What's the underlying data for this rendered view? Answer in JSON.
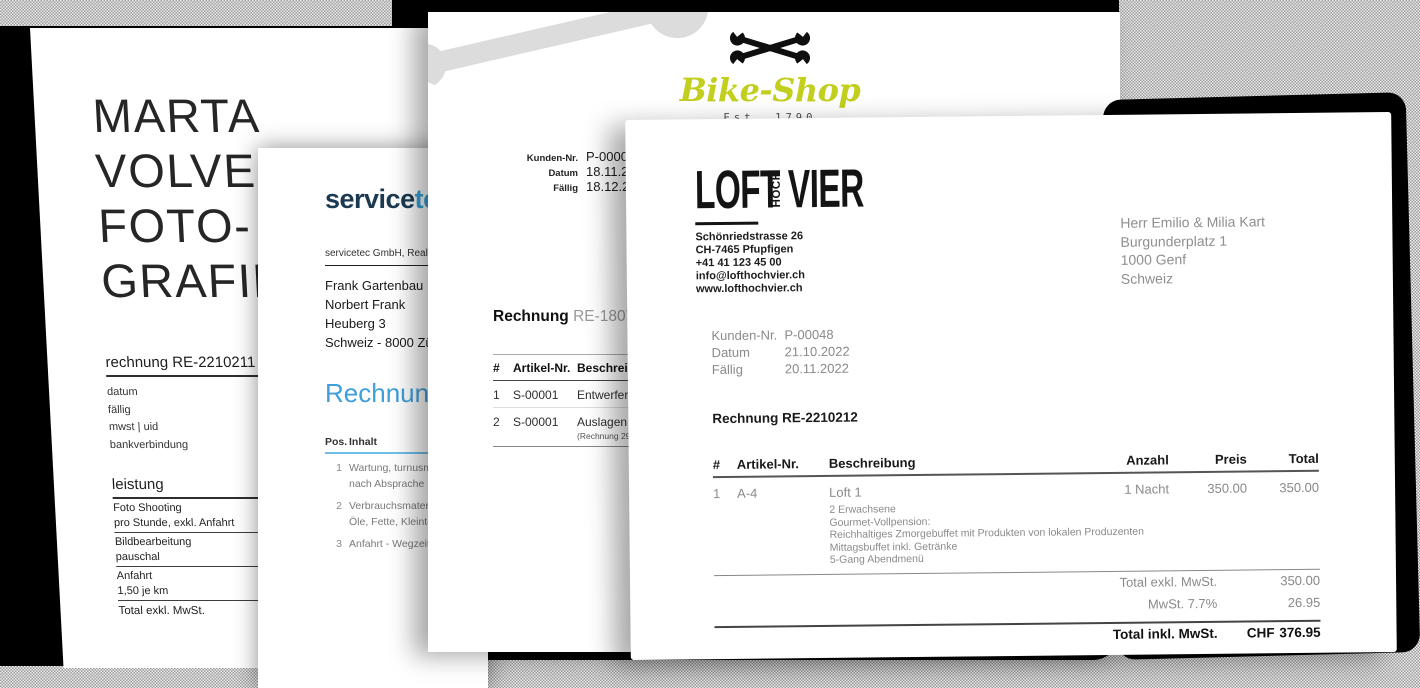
{
  "colors": {
    "backdrop": "#000000",
    "paper": "#ffffff",
    "servicetec_navy": "#1b3a52",
    "servicetec_lightblue": "#38a5dc",
    "servicetec_heading_blue": "#3f9fdb",
    "bikeshop_green": "#c3cf1e",
    "watermark_gray": "#dcdcdc"
  },
  "marta": {
    "title_lines": [
      "MARTA",
      "VOLVER",
      "FOTO-",
      "GRAFIE"
    ],
    "invoice_heading": "rechnung RE-2210211",
    "invoice_fields": [
      "datum",
      "fällig",
      "mwst | uid",
      "bankverbindung"
    ],
    "service_heading": "leistung",
    "service_items": [
      {
        "name": "Foto Shooting",
        "detail": "pro Stunde, exkl. Anfahrt"
      },
      {
        "name": "Bildbearbeitung",
        "detail": "pauschal"
      },
      {
        "name": "Anfahrt",
        "detail": "1,50 je km"
      }
    ],
    "total_label": "Total exkl. MwSt."
  },
  "servicetec": {
    "logo_part1": "service",
    "logo_part2": "tec",
    "sender_line": "servicetec GmbH, Realp",
    "recipient_lines": [
      "Frank Gartenbau",
      "Norbert Frank",
      "Heuberg 3",
      "Schweiz - 8000 Zürich"
    ],
    "heading": "Rechnung",
    "col_pos": "Pos.",
    "col_inhalt": "Inhalt",
    "rows": [
      {
        "pos": "1",
        "line1": "Wartung, turnusmässig",
        "line2": "nach Absprache"
      },
      {
        "pos": "2",
        "line1": "Verbrauchsmaterial",
        "line2": "Öle, Fette, Kleinteile"
      },
      {
        "pos": "3",
        "line1": "Anfahrt - Wegzeit",
        "line2": ""
      }
    ]
  },
  "bikeshop": {
    "logo_name": "Bike-Shop",
    "logo_tagline": "Est. 1790",
    "meta": [
      {
        "label": "Kunden-Nr.",
        "value": "P-00005"
      },
      {
        "label": "Datum",
        "value": "18.11.2018"
      },
      {
        "label": "Fällig",
        "value": "18.12.2018"
      }
    ],
    "heading_word": "Rechnung",
    "heading_number": "RE-1807",
    "col_num": "#",
    "col_article": "Artikel-Nr.",
    "col_desc": "Beschreibung",
    "rows": [
      {
        "num": "1",
        "article": "S-00001",
        "desc": "Entwerfen u",
        "note": ""
      },
      {
        "num": "2",
        "article": "S-00001",
        "desc": "Auslagen D",
        "note": "(Rechnung 291"
      }
    ]
  },
  "loft": {
    "logo_word1": "LOFT",
    "logo_word2": "HOCH",
    "logo_word3": "VIER",
    "sender_lines": [
      "Schönriedstrasse 26",
      "CH-7465 Pfupfigen",
      "+41 41 123 45 00",
      "info@lofthochvier.ch",
      "www.lofthochvier.ch"
    ],
    "recipient_lines": [
      "Herr Emilio & Milia Kart",
      "Burgunderplatz 1",
      "1000 Genf",
      "Schweiz"
    ],
    "meta": [
      {
        "label": "Kunden-Nr.",
        "value": "P-00048"
      },
      {
        "label": "Datum",
        "value": "21.10.2022"
      },
      {
        "label": "Fällig",
        "value": "20.11.2022"
      }
    ],
    "heading": "Rechnung RE-2210212",
    "col_num": "#",
    "col_article": "Artikel-Nr.",
    "col_desc": "Beschreibung",
    "col_qty": "Anzahl",
    "col_price": "Preis",
    "col_total": "Total",
    "row": {
      "num": "1",
      "article": "A-4",
      "desc": "Loft 1",
      "qty": "1 Nacht",
      "price": "350.00",
      "total": "350.00"
    },
    "row_details": [
      "2 Erwachsene",
      "Gourmet-Vollpension:",
      "Reichhaltiges Zmorgebuffet mit Produkten von lokalen Produzenten",
      "Mittagsbuffet inkl. Getränke",
      "5-Gang Abendmenü"
    ],
    "totals": [
      {
        "label": "Total exkl. MwSt.",
        "currency": "",
        "value": "350.00"
      },
      {
        "label": "MwSt. 7.7%",
        "currency": "",
        "value": "26.95"
      }
    ],
    "grand_total": {
      "label": "Total inkl. MwSt.",
      "currency": "CHF",
      "value": "376.95"
    }
  }
}
